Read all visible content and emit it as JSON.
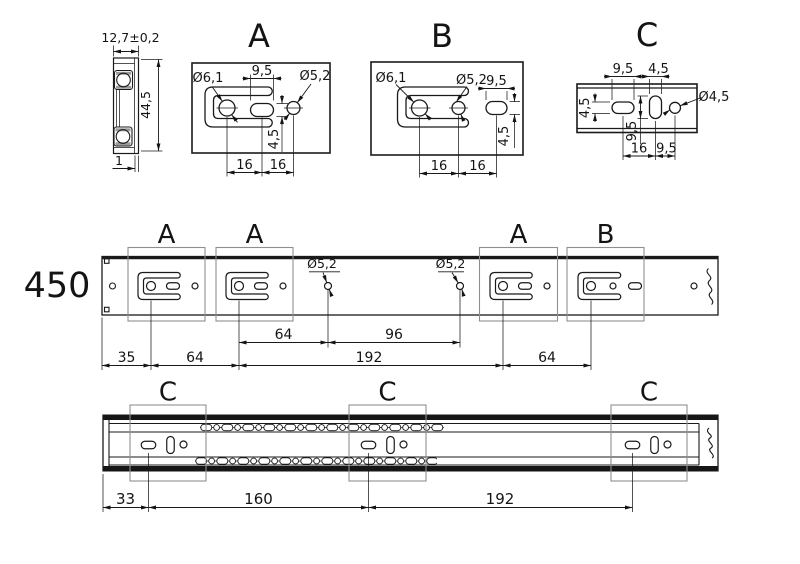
{
  "colors": {
    "line": "#1a1a1a",
    "highlight_box": "#8f8f8f",
    "background": "#ffffff"
  },
  "section_view": {
    "width_dim": "12,7±0,2",
    "height_dim": "44,5",
    "thickness_dim": "1"
  },
  "detail_a": {
    "title": "A",
    "hook_hole_dia": "Ø6,1",
    "slot_width": "9,5",
    "hole_dia": "Ø5,2",
    "slot_height": "4,5",
    "pitch1": "16",
    "pitch2": "16"
  },
  "detail_b": {
    "title": "B",
    "hook_hole_dia": "Ø6,1",
    "hole_dia": "Ø5,2",
    "slot_width": "9,5",
    "slot_height": "4,5",
    "pitch1": "16",
    "pitch2": "16"
  },
  "detail_c": {
    "title": "C",
    "slot_h_width": "9,5",
    "slot_v_width": "4,5",
    "hole_dia": "Ø4,5",
    "slot_h_height": "4,5",
    "slot_v_height": "9,5",
    "pitch1": "16",
    "pitch2": "9,5"
  },
  "top_rail": {
    "length_label": "450",
    "pattern_labels": [
      "A",
      "A",
      "A",
      "B"
    ],
    "hole_callouts": [
      "Ø5,2",
      "Ø5,2"
    ],
    "upper_dims": [
      "64",
      "96"
    ],
    "lower_dims": [
      "35",
      "64",
      "192",
      "64"
    ]
  },
  "bottom_rail": {
    "pattern_labels": [
      "C",
      "C",
      "C"
    ],
    "dims": [
      "33",
      "160",
      "192"
    ]
  }
}
